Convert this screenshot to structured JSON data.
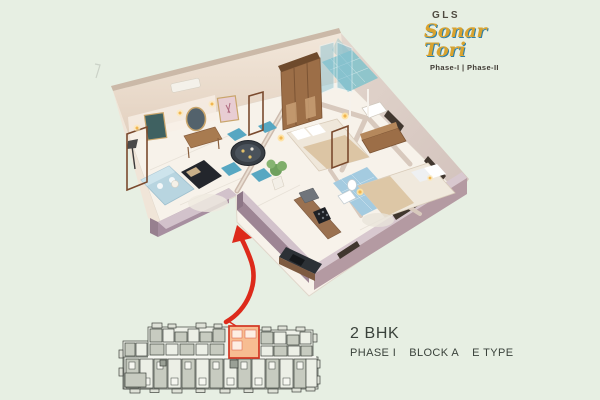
{
  "logo": {
    "brand": "GLS",
    "name": "Sonar Tori",
    "phases": "Phase-I | Phase-II"
  },
  "unit": {
    "type": "2 BHK",
    "phase": "PHASE I",
    "block": "BLOCK A",
    "plan_type": "E TYPE"
  },
  "scene": {
    "description_names": [
      "floor-plan-3d",
      "key-plan",
      "location-arrow"
    ],
    "rooms": [
      "living-room",
      "dining-area",
      "kitchen",
      "master-bedroom",
      "bedroom-2",
      "bathroom-1",
      "bathroom-2",
      "entrance"
    ]
  },
  "colors": {
    "bg": "#e7efe3",
    "text-color": "#3a423b",
    "logo-gold": "#d9a32f",
    "logo-blue": "#2f7fa8",
    "logo-dark": "#4f4a40",
    "arrow": "#dd2a1b",
    "highlight-fill": "#f7bd92",
    "highlight-stroke": "#d23522",
    "wall-mauve": "#b49aa2",
    "wall-cream": "#eee2d4",
    "floor": "#f7f2ea",
    "bath-tile": "#a4cbe0"
  }
}
